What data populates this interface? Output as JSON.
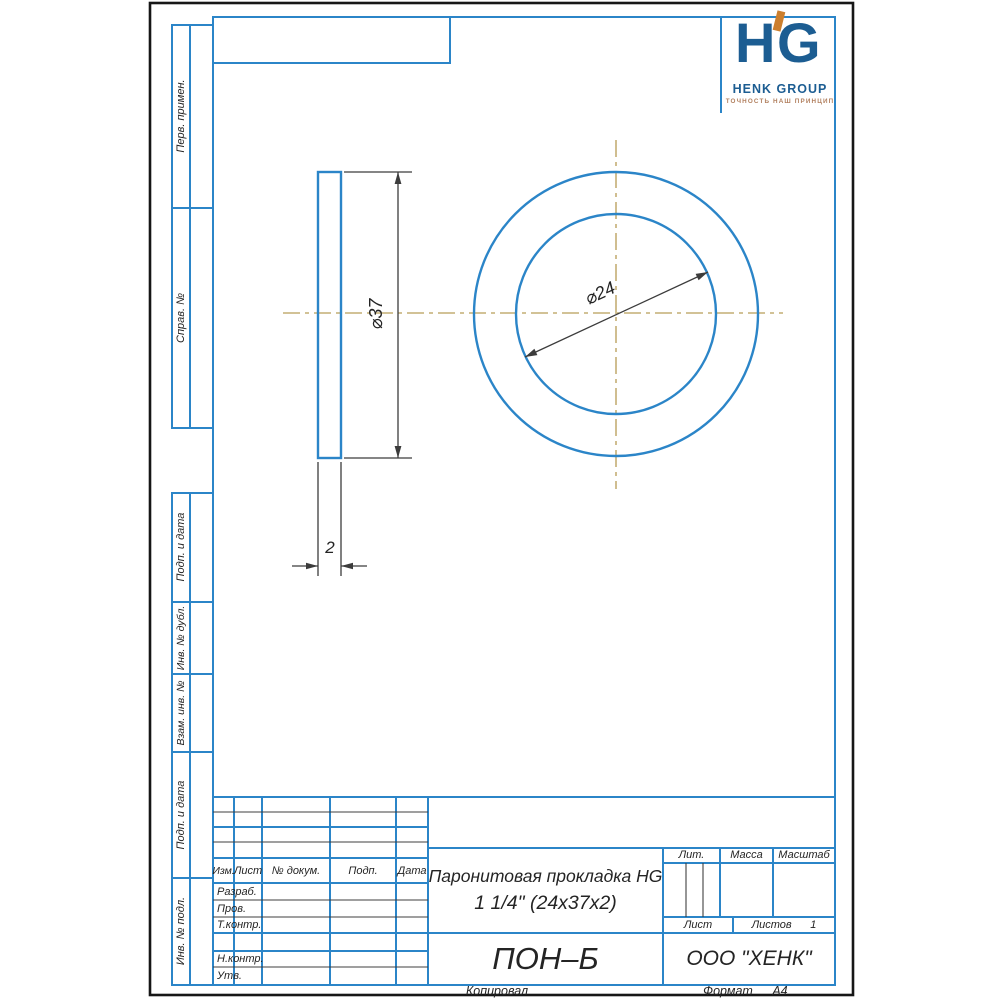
{
  "colors": {
    "frame_blue": "#2b85c8",
    "centerline_tan": "#c4ae74",
    "dim_dark": "#3c3c3c",
    "brand_blue": "#1c5d92",
    "brand_orange": "#cc7f2e",
    "tagline_brown": "#b2805f"
  },
  "logo": {
    "monogram_left": "H",
    "monogram_right": "G",
    "company_name": "HENK GROUP",
    "tagline": "ТОЧНОСТЬ НАШ ПРИНЦИП"
  },
  "sidebar": {
    "cells": [
      {
        "label": "Перв. примен."
      },
      {
        "label": "Справ. №"
      },
      {
        "label": "Подп. и дата"
      },
      {
        "label": "Инв. № дубл."
      },
      {
        "label": "Взам. инв. №"
      },
      {
        "label": "Подп. и дата"
      },
      {
        "label": "Инв. № подл."
      }
    ]
  },
  "title_block": {
    "columns": {
      "c1": "Изм.",
      "c2": "Лист",
      "c3": "№ докум.",
      "c4": "Подп.",
      "c5": "Дата"
    },
    "rows": {
      "r1": "Разраб.",
      "r2": "Пров.",
      "r3": "Т.контр.",
      "r4": "Н.контр.",
      "r5": "Утв."
    },
    "doc_title_line1": "Паронитовая прокладка НG",
    "doc_title_line2": "1 1/4\" (24х37х2)",
    "designation": "ПОН–Б",
    "company": "ООО \"ХЕНК\"",
    "lit_label": "Лит.",
    "mass_label": "Масса",
    "scale_label": "Масштаб",
    "sheet_label": "Лист",
    "sheets_label": "Листов",
    "sheets_value": "1"
  },
  "footer": {
    "copied_label": "Копировал",
    "format_label": "Формат",
    "format_value": "А4"
  },
  "drawing": {
    "dim_outer_diameter": "⌀37",
    "dim_inner_diameter": "⌀24",
    "dim_thickness": "2"
  }
}
